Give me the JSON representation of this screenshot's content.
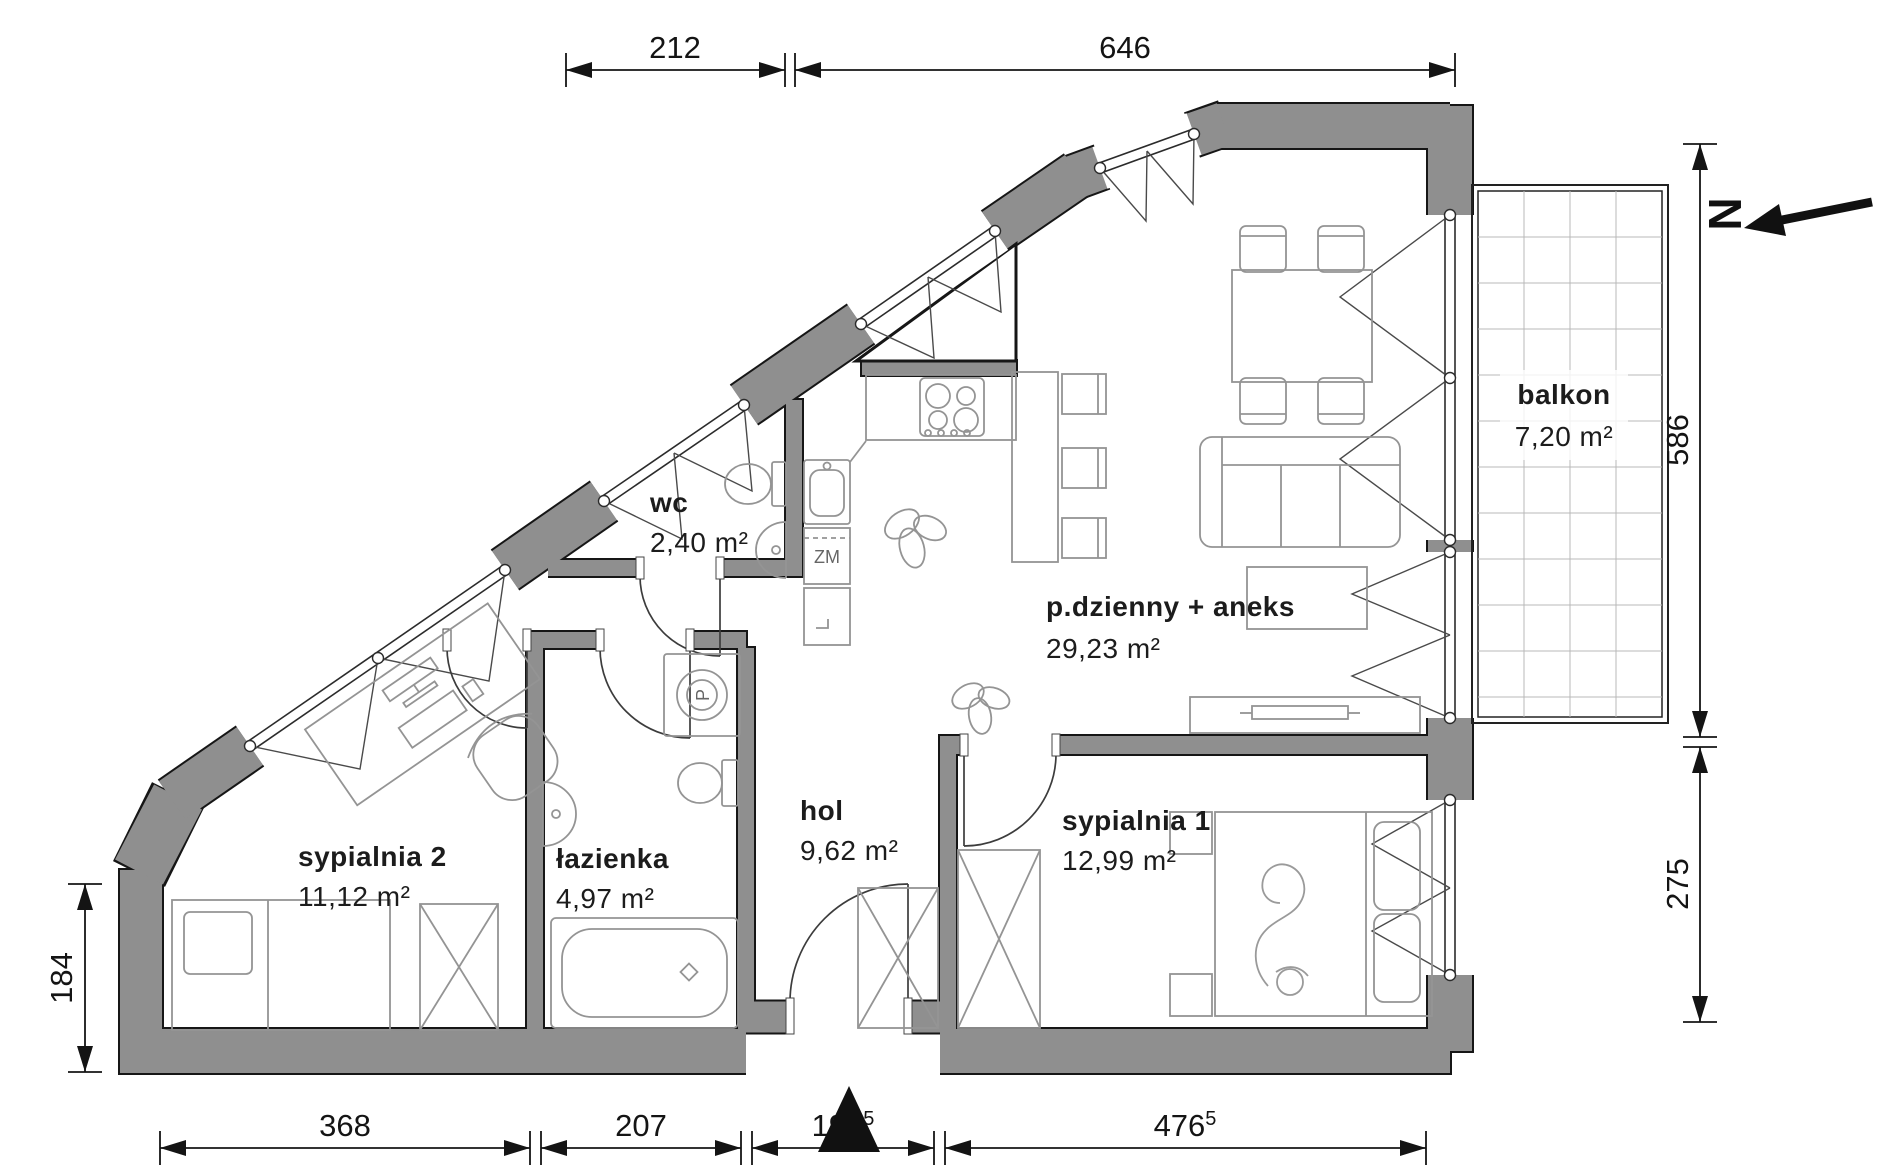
{
  "floorplan": {
    "rooms": [
      {
        "id": "living",
        "name": "p.dzienny + aneks",
        "area": "29,23 m²"
      },
      {
        "id": "balcony",
        "name": "balkon",
        "area": "7,20 m²"
      },
      {
        "id": "bedroom1",
        "name": "sypialnia 1",
        "area": "12,99 m²"
      },
      {
        "id": "bedroom2",
        "name": "sypialnia 2",
        "area": "11,12 m²"
      },
      {
        "id": "bathroom",
        "name": "łazienka",
        "area": "4,97 m²"
      },
      {
        "id": "wc",
        "name": "wc",
        "area": "2,40 m²"
      },
      {
        "id": "hall",
        "name": "hol",
        "area": "9,62 m²"
      }
    ],
    "dimensions_cm": {
      "top": [
        "212",
        "646"
      ],
      "right": [
        "586",
        "275"
      ],
      "left": [
        "184"
      ],
      "bottom": [
        {
          "v": "368",
          "sup": ""
        },
        {
          "v": "207",
          "sup": ""
        },
        {
          "v": "190",
          "sup": "5"
        },
        {
          "v": "476",
          "sup": "5"
        }
      ]
    },
    "appliance_labels": {
      "dishwasher": "ZM",
      "washing_machine": "P"
    },
    "compass_label": "N",
    "colors": {
      "wall_fill": "#8f8f8f",
      "wall_outline": "#161616",
      "dimension": "#141414",
      "label": "#1c1c1c",
      "furniture_line": "#949494",
      "balcony_grid": "#b8b8b8"
    }
  }
}
